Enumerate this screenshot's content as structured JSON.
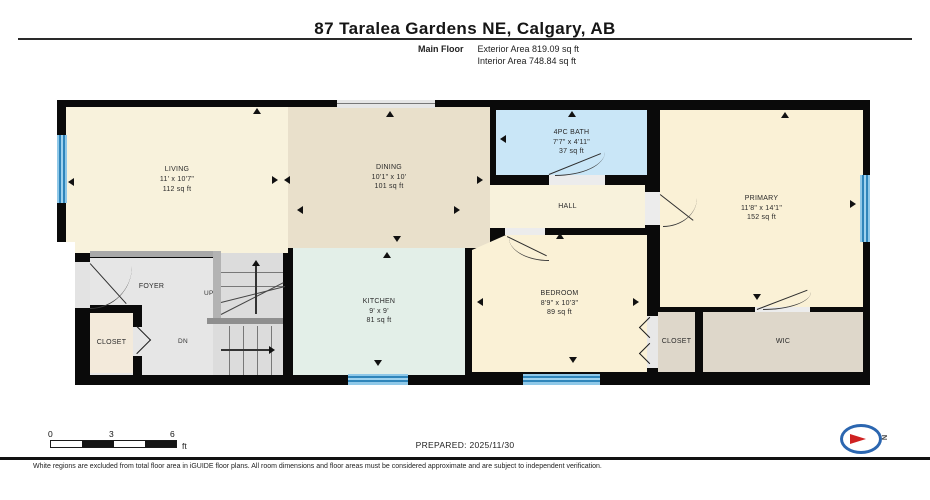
{
  "header": {
    "title": "87 Taralea Gardens NE, Calgary, AB",
    "floor_label": "Main Floor",
    "exterior_area": "Exterior Area 819.09 sq ft",
    "interior_area": "Interior Area 748.84 sq ft"
  },
  "rooms": {
    "living": {
      "name": "LIVING",
      "dims": "11' x 10'7\"",
      "area": "112 sq ft"
    },
    "dining": {
      "name": "DINING",
      "dims": "10'1\" x 10'",
      "area": "101 sq ft"
    },
    "bath": {
      "name": "4PC BATH",
      "dims": "7'7\" x 4'11\"",
      "area": "37 sq ft"
    },
    "hall": {
      "name": "HALL"
    },
    "primary": {
      "name": "PRIMARY",
      "dims": "11'8\" x 14'1\"",
      "area": "152 sq ft"
    },
    "kitchen": {
      "name": "KITCHEN",
      "dims": "9' x 9'",
      "area": "81 sq ft"
    },
    "bedroom": {
      "name": "BEDROOM",
      "dims": "8'9\" x 10'3\"",
      "area": "89 sq ft"
    },
    "foyer": {
      "name": "FOYER"
    },
    "foyer_closet": {
      "name": "CLOSET"
    },
    "bedroom_closet": {
      "name": "CLOSET"
    },
    "wic": {
      "name": "WIC"
    },
    "stairs": {
      "up": "UP",
      "down": "DN"
    }
  },
  "scale_bar": {
    "ticks": [
      "0",
      "3",
      "6"
    ],
    "unit": "ft"
  },
  "prepared": "PREPARED: 2025/11/30",
  "compass": {
    "north_label": "N"
  },
  "footer": {
    "disclaimer": "White regions are excluded from total floor area in iGUIDE floor plans. All room dimensions and floor areas must be considered approximate and are subject to independent verification."
  },
  "colors": {
    "wall": "#0a0a0a",
    "cream_room": "#F8F2DC",
    "dining_tan": "#E9E0CB",
    "kitchen_mint": "#E3EFE8",
    "bath_blue": "#C9E6F7",
    "foyer_gray": "#E6E6E6",
    "closet_tan": "#DED7CA",
    "window_blue": "#2F85BA",
    "compass_blue": "#2B66B0",
    "compass_red": "#CF2222"
  }
}
